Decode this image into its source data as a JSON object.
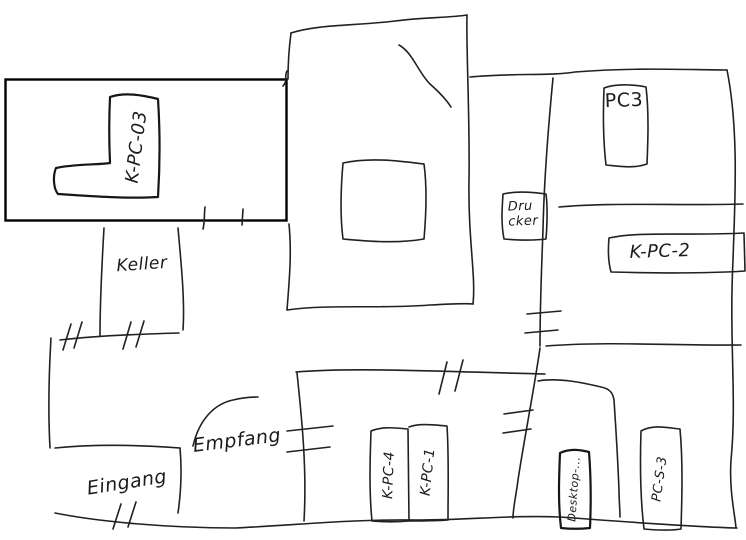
{
  "canvas": {
    "type": "hand-drawn-floorplan-sketch",
    "background_color": "#ffffff",
    "ink_color": "#212121",
    "selection_box_color": "#000000"
  },
  "rooms": {
    "keller": {
      "label": "Keller"
    },
    "empfang": {
      "label": "Empfang"
    },
    "eingang": {
      "label": "Eingang"
    }
  },
  "devices": {
    "k_pc_03": {
      "label": "K-PC-03"
    },
    "pc3": {
      "label": "PC3"
    },
    "drucker": {
      "label_line1": "Dru",
      "label_line2": "cker"
    },
    "k_pc_2": {
      "label": "K-PC-2"
    },
    "k_pc_4": {
      "label": "K-PC-4"
    },
    "k_pc_1": {
      "label": "K-PC-1"
    },
    "desktop": {
      "label": "Desktop-..."
    },
    "pc_s_3": {
      "label": "PC-S-3"
    }
  }
}
